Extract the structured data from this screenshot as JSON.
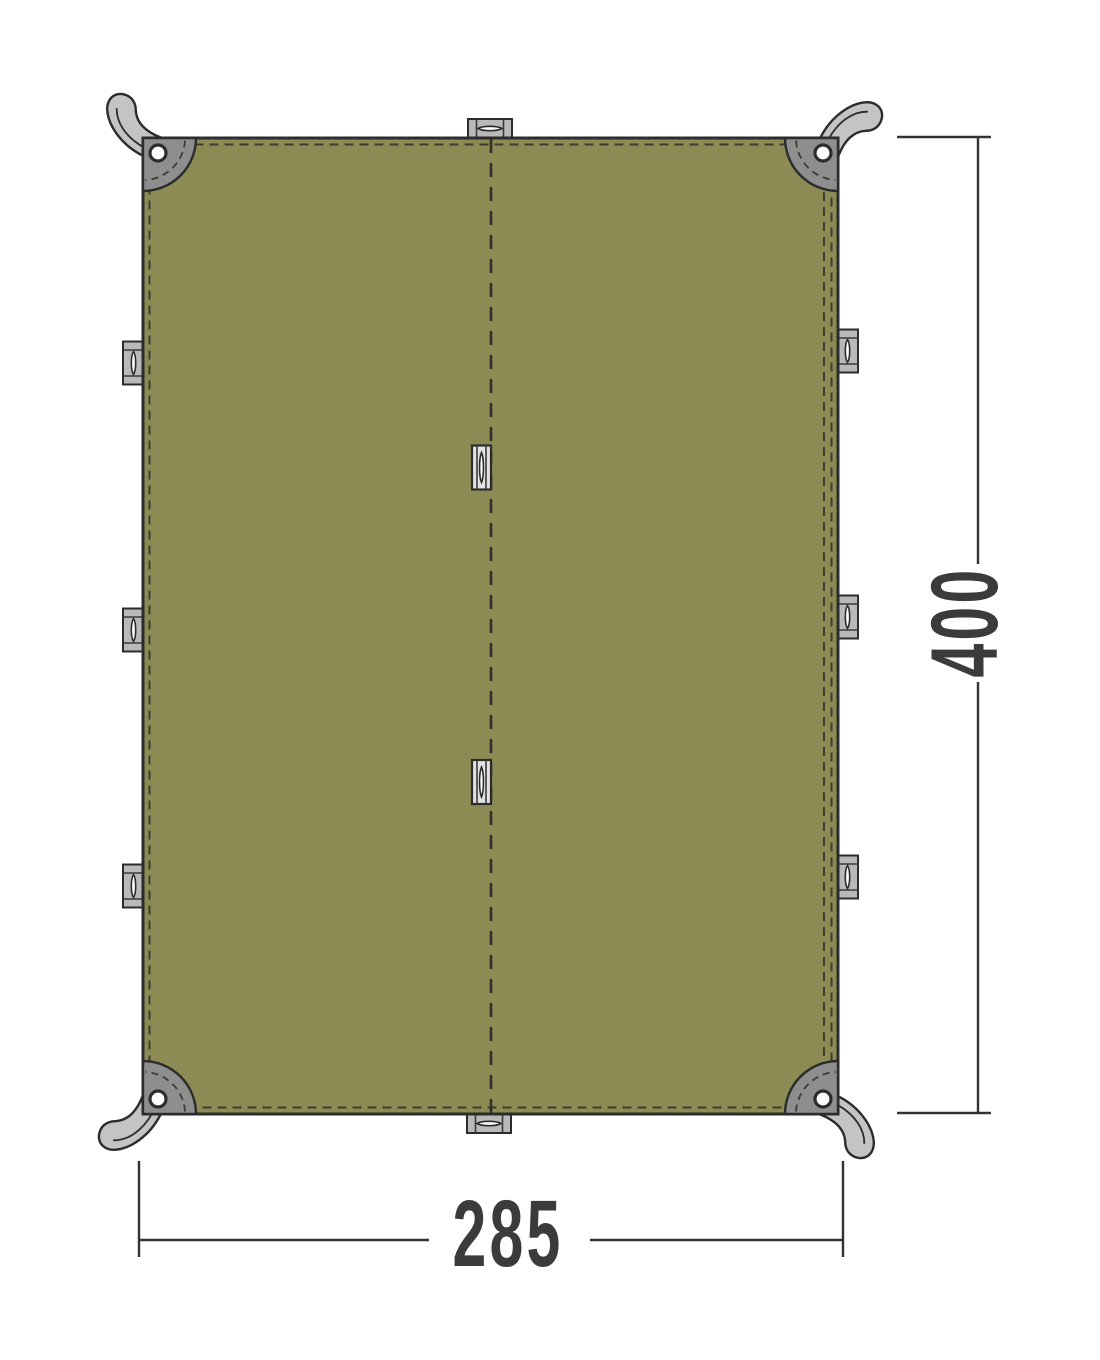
{
  "diagram": {
    "width_label": "285",
    "height_label": "400",
    "colors": {
      "background": "#FFFFFF",
      "tarp": "#8C8B53",
      "outline": "#2C2C2C",
      "corner_patch": "#8E8E8E",
      "strap": "#C4C4C4",
      "edge_loop": "#B9B9B9",
      "seam_loop": "#E2E2E2",
      "stitching": "#3E3E30",
      "dimension": "#3B3B3B"
    },
    "features": {
      "corner_grommets": 4,
      "corner_straps": 4,
      "left_edge_loops": 3,
      "right_edge_loops": 3,
      "top_edge_loops": 1,
      "bottom_edge_loops": 1,
      "center_seam_loops": 2
    }
  }
}
